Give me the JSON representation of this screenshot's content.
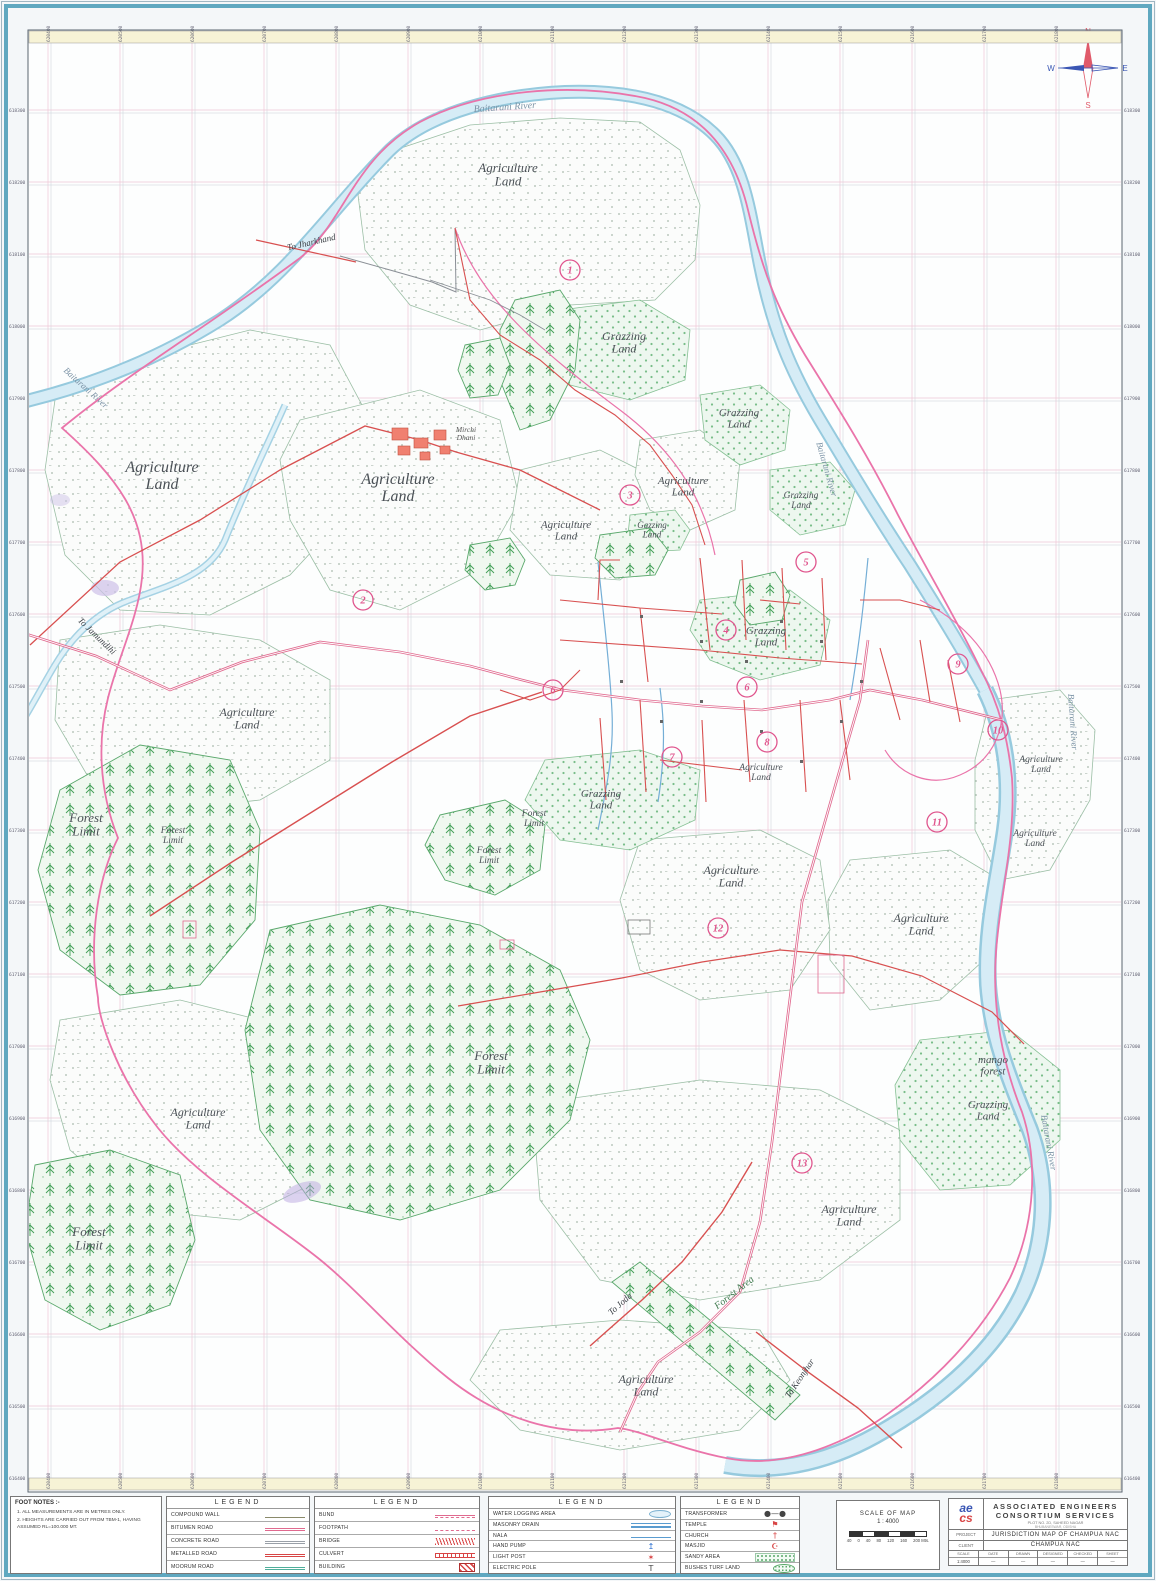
{
  "map": {
    "compass": {
      "n": "N",
      "e": "E",
      "s": "S",
      "w": "W"
    },
    "labels": [
      {
        "t": "Baitarani River",
        "x": 505,
        "y": 110,
        "s": 10,
        "r": -4,
        "c": "#7b93a6"
      },
      {
        "t": "Agriculture\nLand",
        "x": 508,
        "y": 172,
        "s": 13
      },
      {
        "t": "Grazzing\nLand",
        "x": 624,
        "y": 340,
        "s": 12
      },
      {
        "t": "Grazzing\nLand",
        "x": 739,
        "y": 416,
        "s": 11
      },
      {
        "t": "Agriculture\nLand",
        "x": 162,
        "y": 472,
        "s": 16
      },
      {
        "t": "Agriculture\nLand",
        "x": 398,
        "y": 484,
        "s": 16
      },
      {
        "t": "Agriculture\nLand",
        "x": 566,
        "y": 528,
        "s": 11
      },
      {
        "t": "Agriculture\nLand",
        "x": 683,
        "y": 484,
        "s": 11
      },
      {
        "t": "Gazzing\nLand",
        "x": 652,
        "y": 528,
        "s": 9
      },
      {
        "t": "Grazzing\nLand",
        "x": 801,
        "y": 498,
        "s": 9.5
      },
      {
        "t": "Grazzing\nLand",
        "x": 766,
        "y": 634,
        "s": 11
      },
      {
        "t": "Agriculture\nLand",
        "x": 247,
        "y": 716,
        "s": 12
      },
      {
        "t": "Agriculture\nLand",
        "x": 761,
        "y": 770,
        "s": 9.5
      },
      {
        "t": "Agriculture\nLand",
        "x": 1041,
        "y": 762,
        "s": 9.5
      },
      {
        "t": "Agriculture\nLand",
        "x": 1035,
        "y": 836,
        "s": 9.5
      },
      {
        "t": "Grazzing\nLand",
        "x": 601,
        "y": 797,
        "s": 11
      },
      {
        "t": "Forest\nLimit",
        "x": 86,
        "y": 822,
        "s": 13
      },
      {
        "t": "Forest\nLimit",
        "x": 173,
        "y": 833,
        "s": 9.5
      },
      {
        "t": "Forest\nLimit",
        "x": 534,
        "y": 816,
        "s": 9.5
      },
      {
        "t": "Forest\nLimit",
        "x": 489,
        "y": 853,
        "s": 9.5
      },
      {
        "t": "Agriculture\nLand",
        "x": 731,
        "y": 874,
        "s": 12
      },
      {
        "t": "Agriculture\nLand",
        "x": 921,
        "y": 922,
        "s": 12
      },
      {
        "t": "Forest\nLimit",
        "x": 491,
        "y": 1060,
        "s": 13
      },
      {
        "t": "Agriculture\nLand",
        "x": 198,
        "y": 1116,
        "s": 12
      },
      {
        "t": "mango\nforest",
        "x": 993,
        "y": 1063,
        "s": 11
      },
      {
        "t": "Grazzing\nLand",
        "x": 988,
        "y": 1108,
        "s": 11
      },
      {
        "t": "Agriculture\nLand",
        "x": 849,
        "y": 1213,
        "s": 12
      },
      {
        "t": "Forest\nLimit",
        "x": 89,
        "y": 1236,
        "s": 13
      },
      {
        "t": "Agriculture\nLand",
        "x": 646,
        "y": 1383,
        "s": 12
      },
      {
        "t": "Forest Area",
        "x": 736,
        "y": 1295,
        "s": 10,
        "r": -38,
        "c": "#3f7a4e"
      },
      {
        "t": "Mirchi\nDhani",
        "x": 466,
        "y": 432,
        "s": 7.5,
        "c": "#555555"
      },
      {
        "t": "Baitarani River",
        "x": 84,
        "y": 390,
        "s": 9,
        "r": 42,
        "c": "#7b93a6"
      },
      {
        "t": "Baitarani River",
        "x": 824,
        "y": 470,
        "s": 9,
        "r": 74,
        "c": "#7b93a6"
      },
      {
        "t": "Baitarani River",
        "x": 1070,
        "y": 722,
        "s": 9,
        "r": 86,
        "c": "#7b93a6"
      },
      {
        "t": "Baitarani River",
        "x": 1046,
        "y": 1143,
        "s": 9,
        "r": 80,
        "c": "#7b93a6"
      },
      {
        "t": "To Jharkhand",
        "x": 312,
        "y": 245,
        "s": 9,
        "r": -13,
        "c": "#3a3f45"
      },
      {
        "t": "To Jamundihi",
        "x": 95,
        "y": 638,
        "s": 9,
        "r": 44,
        "c": "#3a3f45"
      },
      {
        "t": "To Joda",
        "x": 622,
        "y": 1306,
        "s": 9,
        "r": -42,
        "c": "#3a3f45"
      },
      {
        "t": "To Keonjhar",
        "x": 802,
        "y": 1380,
        "s": 9,
        "r": -56,
        "c": "#3a3f45"
      }
    ],
    "wards": [
      {
        "n": "1",
        "x": 570,
        "y": 270
      },
      {
        "n": "2",
        "x": 363,
        "y": 600
      },
      {
        "n": "3",
        "x": 630,
        "y": 495
      },
      {
        "n": "4",
        "x": 726,
        "y": 630
      },
      {
        "n": "5",
        "x": 806,
        "y": 562
      },
      {
        "n": "6",
        "x": 553,
        "y": 690
      },
      {
        "n": "6",
        "x": 747,
        "y": 687
      },
      {
        "n": "7",
        "x": 672,
        "y": 757
      },
      {
        "n": "8",
        "x": 767,
        "y": 742
      },
      {
        "n": "9",
        "x": 958,
        "y": 664
      },
      {
        "n": "10",
        "x": 998,
        "y": 730
      },
      {
        "n": "11",
        "x": 937,
        "y": 822
      },
      {
        "n": "12",
        "x": 718,
        "y": 928
      },
      {
        "n": "13",
        "x": 802,
        "y": 1163
      }
    ],
    "grid": {
      "top": [
        "620400",
        "620500",
        "620600",
        "620700",
        "620800",
        "620900",
        "621000",
        "621100",
        "621200",
        "621300",
        "621400",
        "621500",
        "621600",
        "621700",
        "621800"
      ],
      "side": [
        "618300",
        "618200",
        "618100",
        "618000",
        "617900",
        "617800",
        "617700",
        "617600",
        "617500",
        "617400",
        "617300",
        "617200",
        "617100",
        "617000",
        "616900",
        "616800",
        "616700",
        "616600",
        "616500",
        "616400"
      ]
    }
  },
  "footnotes": {
    "title": "FOOT NOTES :-",
    "items": [
      "1.  ALL MEASUREMENTS ARE IN METRES ONLY.",
      "2.  HEIGHTS ARE CARRIED OUT FROM TBM-1, HAVING ASSUMED RL=100.000 MT."
    ]
  },
  "legends": [
    {
      "title": "LEGEND",
      "rows": [
        {
          "label": "COMPOUND WALL",
          "swatch": "wall"
        },
        {
          "label": "BITUMEN ROAD",
          "swatch": "pink2"
        },
        {
          "label": "CONCRETE ROAD",
          "swatch": "grey2"
        },
        {
          "label": "METALLED ROAD",
          "swatch": "red2"
        },
        {
          "label": "MOORUM ROAD",
          "swatch": "teal2"
        }
      ]
    },
    {
      "title": "LEGEND",
      "rows": [
        {
          "label": "BUND",
          "swatch": "pink2t"
        },
        {
          "label": "FOOTPATH",
          "swatch": "pinkdash"
        },
        {
          "label": "BRIDGE",
          "swatch": "redhatch"
        },
        {
          "label": "CULVERT",
          "swatch": "culvert"
        },
        {
          "label": "BUILDING",
          "swatch": "building"
        }
      ]
    },
    {
      "title": "LEGEND",
      "rows": [
        {
          "label": "WATER LOGGING AREA",
          "swatch": "wellipse"
        },
        {
          "label": "MASONRY DRAIN",
          "swatch": "blue3"
        },
        {
          "label": "NALA",
          "swatch": "blue1"
        },
        {
          "label": "HAND PUMP",
          "swatch": "glyph",
          "glyph": "↥",
          "color": "#2a6fd0"
        },
        {
          "label": "LIGHT POST",
          "swatch": "glyph",
          "glyph": "✶",
          "color": "#d84545"
        },
        {
          "label": "ELECTRIC POLE",
          "swatch": "glyph",
          "glyph": "T",
          "color": "#444444"
        }
      ]
    },
    {
      "title": "LEGEND",
      "rows": [
        {
          "label": "TRANSFORMER",
          "swatch": "glyph",
          "glyph": "●—●",
          "color": "#444444"
        },
        {
          "label": "TEMPLE",
          "swatch": "glyph",
          "glyph": "⚑",
          "color": "#d84545"
        },
        {
          "label": "CHURCH",
          "swatch": "glyph",
          "glyph": "†",
          "color": "#d84545"
        },
        {
          "label": "MASJID",
          "swatch": "glyph",
          "glyph": "☪",
          "color": "#d84545"
        },
        {
          "label": "SANDY AREA",
          "swatch": "sandy"
        },
        {
          "label": "BUSHES TURF LAND",
          "swatch": "turf"
        }
      ]
    }
  ],
  "scalebox": {
    "line1": "SCALE OF MAP",
    "line2": "1 : 4000",
    "bar_labels": [
      "40",
      "0",
      "40",
      "80",
      "120",
      "160",
      "200 Mts."
    ]
  },
  "titleblock": {
    "logo_top": "ae",
    "logo_bottom": "cs",
    "company_line1": "ASSOCIATED ENGINEERS",
    "company_line2": "CONSORTIUM SERVICES",
    "address1": "PLOT NO. 2D, SAHEED NAGAR",
    "address2": "BHUBANESWAR, ODISHA",
    "project_label": "PROJECT",
    "project_value": "JURISDICTION MAP OF CHAMPUA NAC",
    "client_label": "CLIENT",
    "client_value": "CHAMPUA NAC",
    "table": {
      "headers": [
        "SCALE",
        "DATE",
        "DRAWN",
        "DESIGNED",
        "CHECKED",
        "SHEET"
      ],
      "values": [
        "1:4000",
        "—",
        "—",
        "—",
        "—",
        "—"
      ]
    }
  }
}
